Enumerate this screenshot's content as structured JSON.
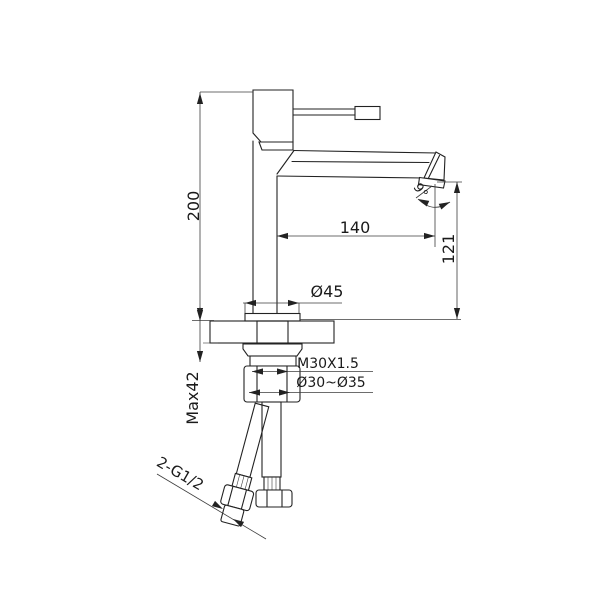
{
  "page": {
    "type": "technical-drawing",
    "subject": "single-handle basin faucet, side elevation with installation dimensions",
    "background": "#ffffff"
  },
  "drawing": {
    "colors": {
      "line": "#222222",
      "dim": "#3c3c3c",
      "text": "#1a1a1a",
      "knurl_fill": "#c6c6c6",
      "thread_fill": "#bdbdbd",
      "braid_fill": "#f3f3f3"
    },
    "labels": {
      "total_height": "200",
      "spout_reach": "140",
      "outlet_height": "121",
      "outlet_angle": "9°",
      "base_diameter": "Ø45",
      "thread_spec": "M30X1.5",
      "hole_range": "Ø30~Ø35",
      "max_deck_thickness": "Max42",
      "hose_connection": "2-G1/2"
    }
  }
}
